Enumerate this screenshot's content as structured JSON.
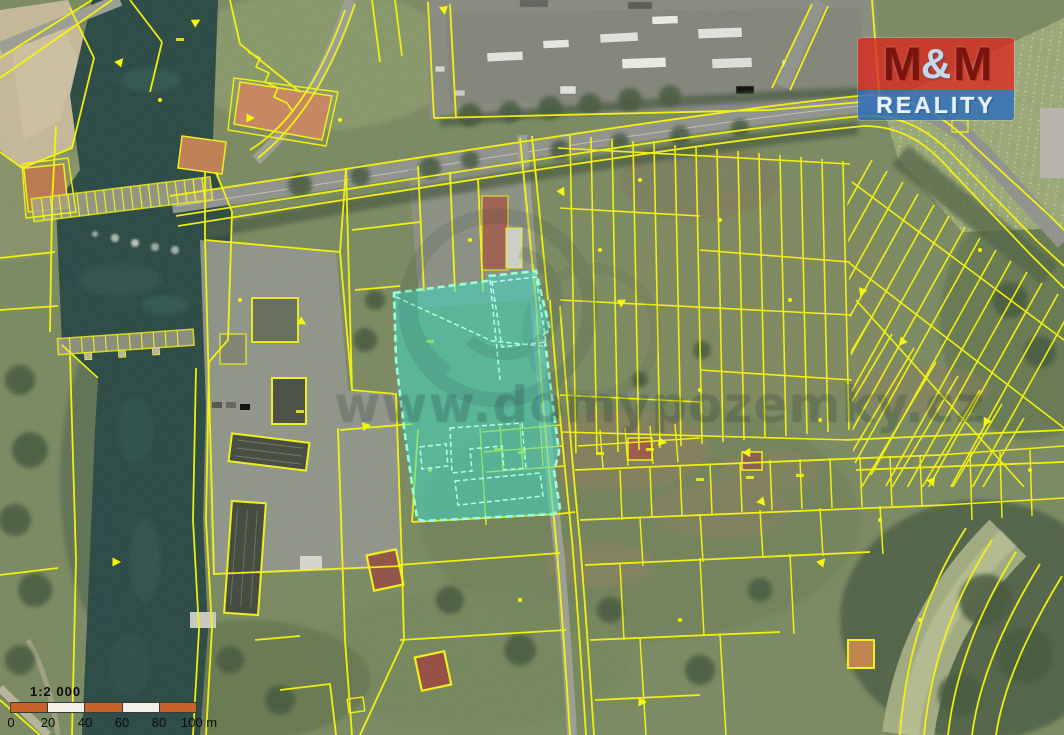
{
  "branding": {
    "logo": {
      "m_left": "M",
      "ampersand": "&",
      "m_right": "M",
      "reality": "REALITY"
    }
  },
  "watermark": {
    "text": "www.domypozemky.cz"
  },
  "scalebar": {
    "ratio_label": "1:2 000",
    "tick_labels": [
      "0",
      "20",
      "40",
      "60",
      "80",
      "100 m"
    ]
  },
  "map": {
    "type": "cadastral-aerial-orthophoto",
    "highlighted_parcel_fill": "#3fd9c4",
    "highlighted_parcel_stroke": "#9bffd4",
    "parcel_line_color": "#f6f60e",
    "water_color": "#20403c",
    "logo_red": "#dd261e",
    "logo_blue": "#2c6ebc",
    "scalebar_orange": "#c8622b"
  }
}
